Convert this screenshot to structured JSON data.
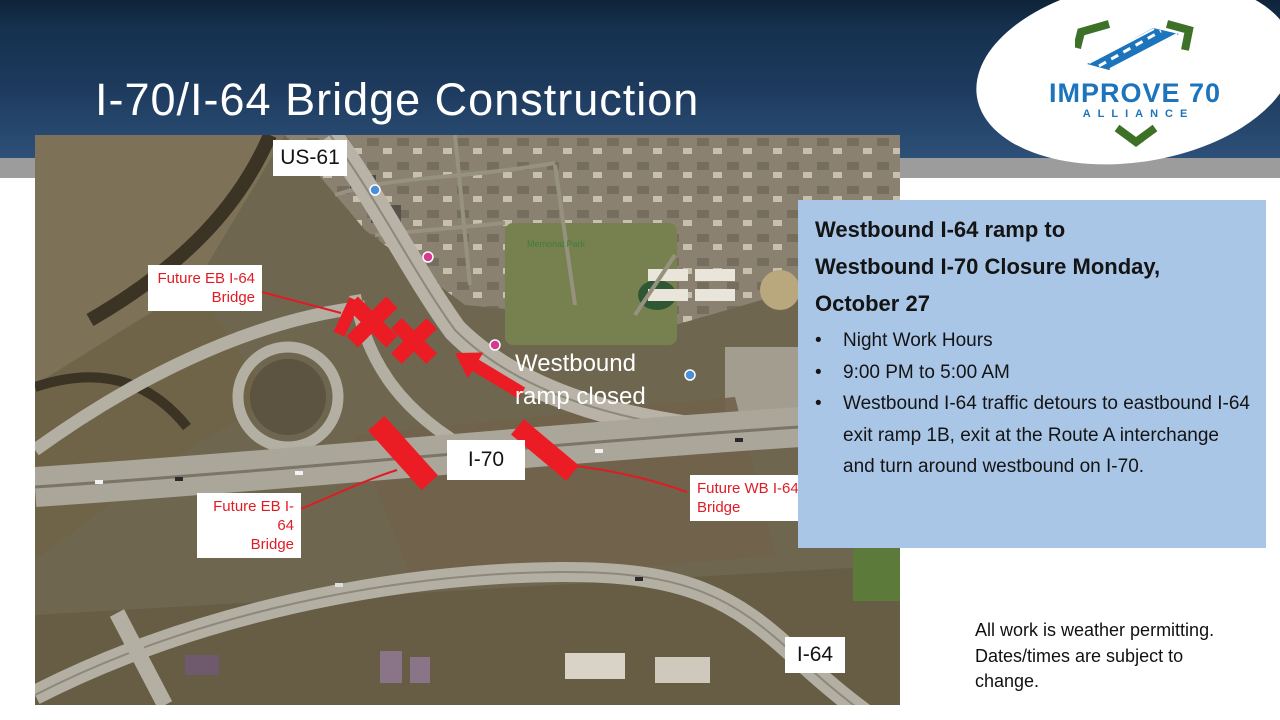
{
  "header": {
    "title": "I-70/I-64 Bridge Construction"
  },
  "logo": {
    "name": "IMPROVE 70",
    "subtitle": "ALLIANCE",
    "blue": "#1c75bc",
    "green": "#3e7128"
  },
  "map": {
    "road_labels": {
      "us61": "US-61",
      "i70": "I-70",
      "i64": "I-64"
    },
    "poi_label": "Memorial Park",
    "annotation_color": "#e8131b",
    "callouts": {
      "future_eb_top": {
        "line1": "Future EB I-64",
        "line2": "Bridge"
      },
      "future_eb_bottom": {
        "line1": "Future EB I-64",
        "line2": "Bridge"
      },
      "future_wb": {
        "line1": "Future WB I-64",
        "line2": "Bridge"
      },
      "ramp_closed": {
        "line1": "Westbound",
        "line2": "ramp closed"
      }
    }
  },
  "infobox": {
    "bg": "#a9c6e7",
    "title_lines": [
      "Westbound I-64 ramp to",
      "Westbound I-70 Closure Monday,",
      "October 27"
    ],
    "bullet_char": "•",
    "bullets": [
      "Night Work Hours",
      "9:00 PM to 5:00 AM",
      "Westbound I-64 traffic detours to eastbound I-64 exit ramp 1B, exit at the Route A interchange and turn around westbound on I-70."
    ]
  },
  "note": {
    "lines": [
      "All work is weather permitting.",
      "Dates/times are subject to",
      "change."
    ]
  }
}
